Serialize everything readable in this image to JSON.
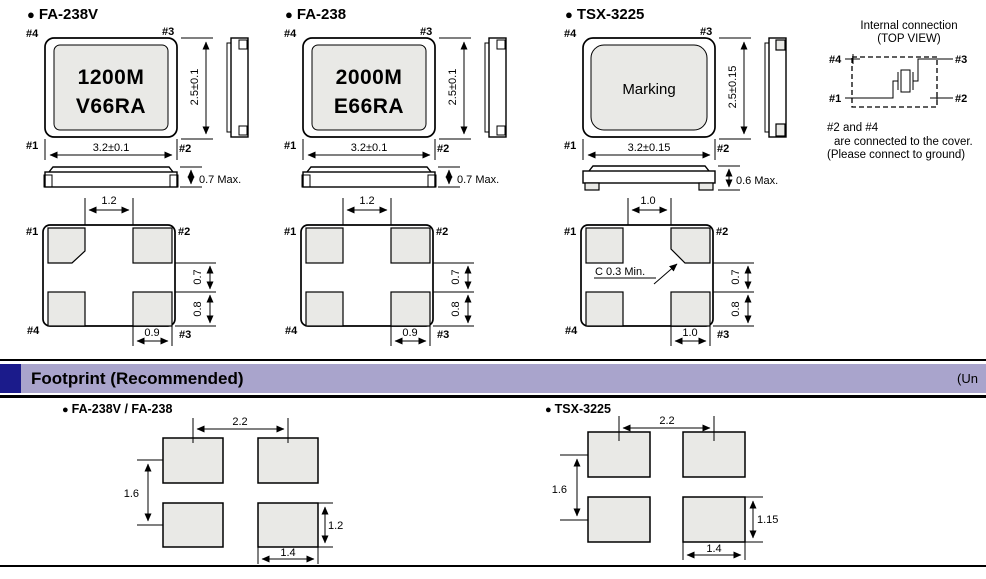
{
  "bullet": "●",
  "colors": {
    "accent_bar": "#a9a4cc",
    "accent_square": "#1b1b8b",
    "pad_fill": "#e9e9e6"
  },
  "packages": [
    {
      "name": "FA-238V",
      "marking_line1": "1200M",
      "marking_line2": "V66RA",
      "top_pins": {
        "tl": "#4",
        "tr": "#3",
        "bl": "#1",
        "br": "#2"
      },
      "bottom_pins": {
        "tl": "#1",
        "tr": "#2",
        "bl": "#4",
        "br": "#3"
      },
      "dim_width": "3.2±0.1",
      "dim_height": "2.5±0.1",
      "dim_thickness": "0.7 Max.",
      "dim_pad_spacing_top": "1.2",
      "dim_pad_gap_right": "0.7",
      "dim_pad_height_right": "0.8",
      "dim_pad_width_bottom": "0.9"
    },
    {
      "name": "FA-238",
      "marking_line1": "2000M",
      "marking_line2": "E66RA",
      "top_pins": {
        "tl": "#4",
        "tr": "#3",
        "bl": "#1",
        "br": "#2"
      },
      "bottom_pins": {
        "tl": "#1",
        "tr": "#2",
        "bl": "#4",
        "br": "#3"
      },
      "dim_width": "3.2±0.1",
      "dim_height": "2.5±0.1",
      "dim_thickness": "0.7 Max.",
      "dim_pad_spacing_top": "1.2",
      "dim_pad_gap_right": "0.7",
      "dim_pad_height_right": "0.8",
      "dim_pad_width_bottom": "0.9"
    },
    {
      "name": "TSX-3225",
      "marking_line1": "Marking",
      "top_pins": {
        "tl": "#4",
        "tr": "#3",
        "bl": "#1",
        "br": "#2"
      },
      "bottom_pins": {
        "tl": "#1",
        "tr": "#2",
        "bl": "#4",
        "br": "#3"
      },
      "dim_width": "3.2±0.15",
      "dim_height": "2.5±0.15",
      "dim_thickness": "0.6 Max.",
      "dim_pad_spacing_top": "1.0",
      "dim_pad_gap_right": "0.7",
      "dim_pad_height_right": "0.8",
      "dim_pad_width_bottom": "1.0",
      "chamfer_note": "C 0.3 Min."
    }
  ],
  "internal_connection": {
    "title": "Internal connection",
    "subtitle": "(TOP VIEW)",
    "pins": {
      "tl": "#4",
      "tr": "#3",
      "bl": "#1",
      "br": "#2"
    },
    "note_line1": "#2 and #4",
    "note_line2": "are connected to the cover.",
    "note_line3": "(Please connect to ground)"
  },
  "footprint_section": {
    "title": "Footprint (Recommended)",
    "unit_label": "(Un",
    "footprints": [
      {
        "name": "FA-238V / FA-238",
        "dim_pitch_x": "2.2",
        "dim_pitch_y": "1.6",
        "dim_pad_height": "1.2",
        "dim_pad_width": "1.4"
      },
      {
        "name": "TSX-3225",
        "dim_pitch_x": "2.2",
        "dim_pitch_y": "1.6",
        "dim_pad_height": "1.15",
        "dim_pad_width": "1.4"
      }
    ]
  }
}
